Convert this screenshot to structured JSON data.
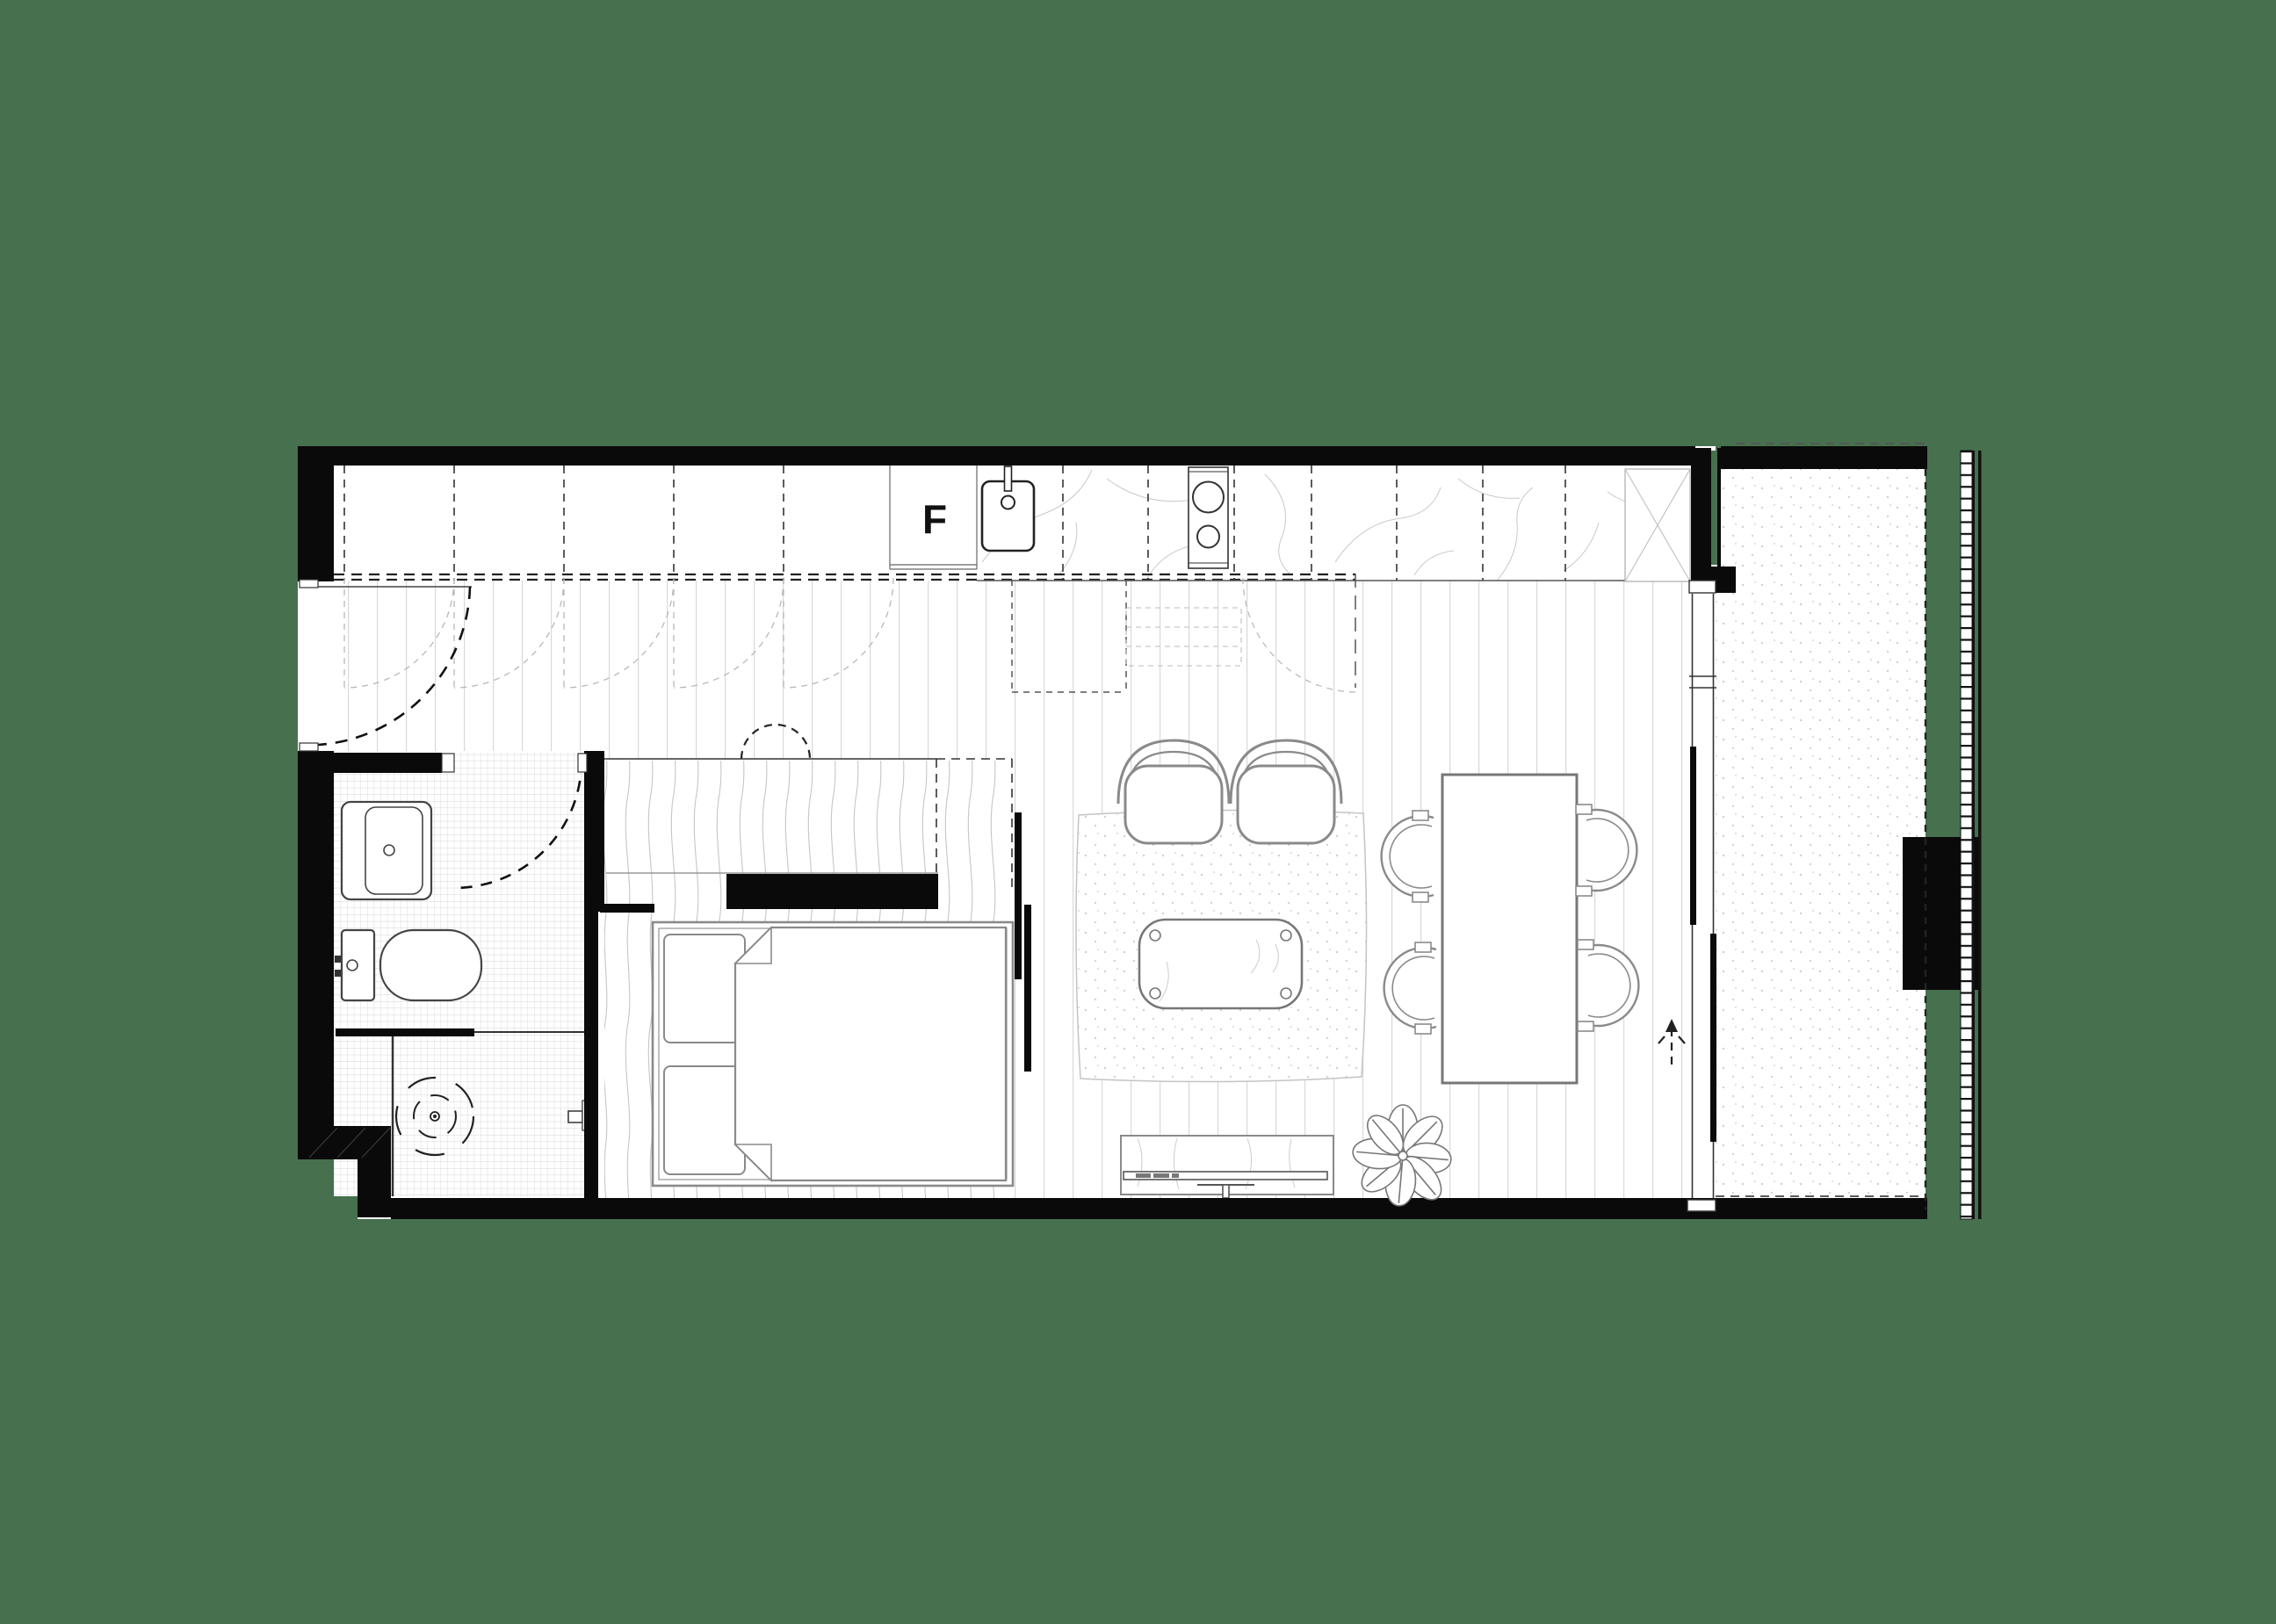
{
  "plan": {
    "fridge_label": "F"
  },
  "colors": {
    "background": "#46704E",
    "wall": "#0A0A0A",
    "furniture_line": "#8A8A8A",
    "floorboard_line": "#D8D8D8",
    "tile_line": "#C6C6C6",
    "dash_line": "#444444"
  }
}
